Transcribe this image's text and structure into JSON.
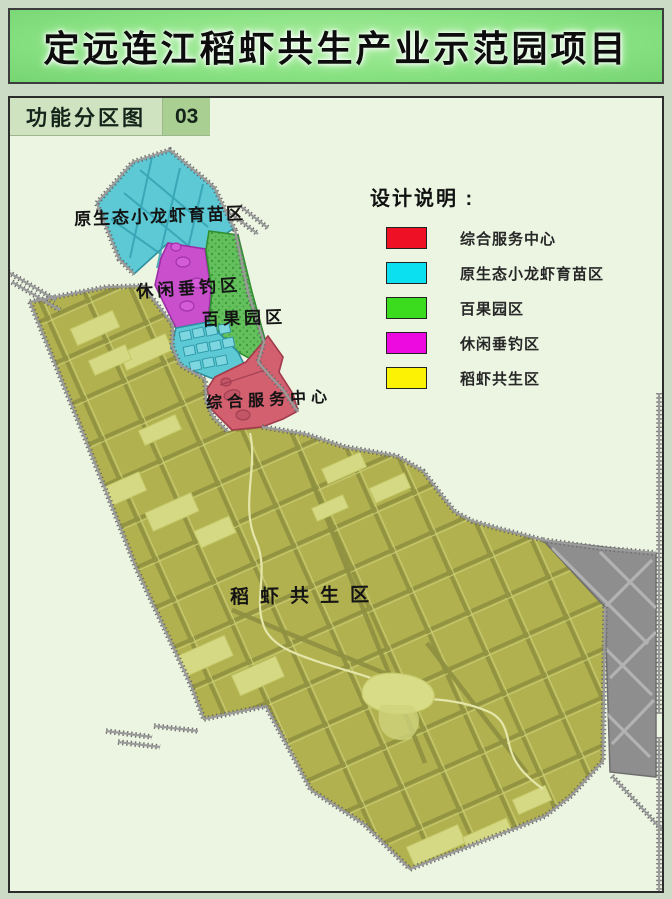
{
  "page": {
    "title": "定远连江稻虾共生产业示范园项目"
  },
  "map_panel": {
    "tag_label": "功能分区图",
    "tag_number": "03"
  },
  "legend": {
    "title": "设计说明 :",
    "items": [
      {
        "label": "综合服务中心",
        "color": "#ee1126"
      },
      {
        "label": "原生态小龙虾育苗区",
        "color": "#0ae0ef"
      },
      {
        "label": "百果园区",
        "color": "#3bdc1e"
      },
      {
        "label": "休闲垂钓区",
        "color": "#ec0ae0"
      },
      {
        "label": "稻虾共生区",
        "color": "#fcf204"
      }
    ]
  },
  "map_labels": {
    "crayfish_nursery": "原生态小龙虾育苗区",
    "leisure_fishing": "休闲垂钓区",
    "orchard": "百果园区",
    "service_center": "综合服务中心",
    "rice_shrimp": "稻虾共生区"
  },
  "zone_fills": {
    "crayfish_nursery": "#5cc9d4",
    "orchard": "#63c05c",
    "leisure_fishing": "#c94fcd",
    "service_center": "#d2606e",
    "rice_shrimp": "#b2b150",
    "built_area": "#8e8e8e"
  }
}
